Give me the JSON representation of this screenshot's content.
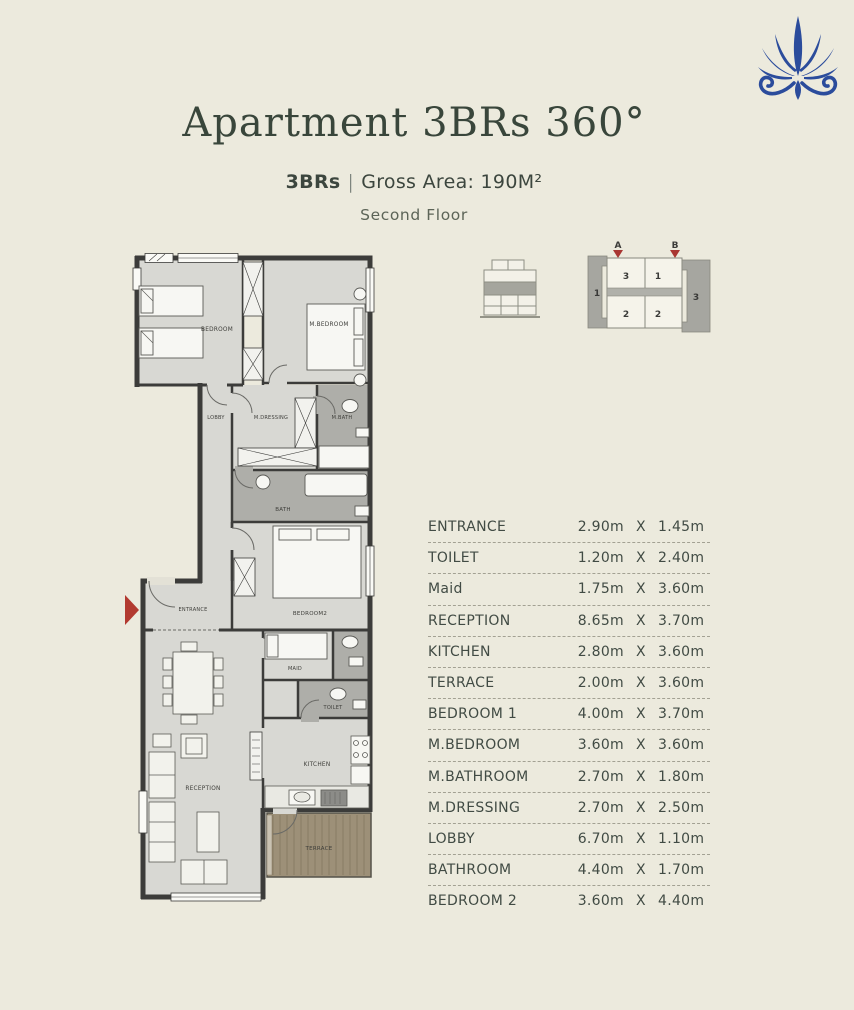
{
  "header": {
    "title": "Apartment 3BRs 360°",
    "unit_type": "3BRs",
    "separator": "|",
    "gross_area": "Gross Area: 190M²",
    "floor": "Second Floor"
  },
  "colors": {
    "background": "#ECEADD",
    "title_green": "#39463B",
    "table_text": "#414B44",
    "logo_blue": "#2B4C9C",
    "wall_dark": "#3C3C3A",
    "room_fill": "#D8D8D3",
    "wet_room_fill": "#AEAEA9",
    "terrace_wood": "#9D9078",
    "entrance_arrow_red": "#B23A30"
  },
  "key_plan": {
    "marker_a": "A",
    "marker_b": "B",
    "side_left_unit": "1",
    "side_right_unit": "3",
    "unit_top_left": "3",
    "unit_top_right": "1",
    "unit_bottom_left": "2",
    "unit_bottom_right": "2"
  },
  "floor_plan": {
    "labels": {
      "bedroom": "BEDROOM",
      "m_bedroom": "M.BEDROOM",
      "lobby": "LOBBY",
      "m_dressing": "M.DRESSING",
      "m_bath": "M.BATH",
      "bath": "BATH",
      "entrance": "ENTRANCE",
      "bedroom2": "BEDROOM2",
      "maid": "MAID",
      "toilet": "TOILET",
      "kitchen": "KITCHEN",
      "reception": "RECEPTION",
      "terrace": "TERRACE"
    }
  },
  "dimensions_table": {
    "rows": [
      {
        "label": "ENTRANCE",
        "width": "2.90m",
        "x": "X",
        "depth": "1.45m"
      },
      {
        "label": "TOILET",
        "width": "1.20m",
        "x": "X",
        "depth": "2.40m"
      },
      {
        "label": "Maid",
        "width": "1.75m",
        "x": "X",
        "depth": "3.60m"
      },
      {
        "label": "RECEPTION",
        "width": "8.65m",
        "x": "X",
        "depth": "3.70m"
      },
      {
        "label": "KITCHEN",
        "width": "2.80m",
        "x": "X",
        "depth": "3.60m"
      },
      {
        "label": "TERRACE",
        "width": "2.00m",
        "x": "X",
        "depth": "3.60m"
      },
      {
        "label": "BEDROOM 1",
        "width": "4.00m",
        "x": "X",
        "depth": "3.70m"
      },
      {
        "label": "M.BEDROOM",
        "width": "3.60m",
        "x": "X",
        "depth": "3.60m"
      },
      {
        "label": "M.BATHROOM",
        "width": "2.70m",
        "x": "X",
        "depth": "1.80m"
      },
      {
        "label": "M.DRESSING",
        "width": "2.70m",
        "x": "X",
        "depth": "2.50m"
      },
      {
        "label": "LOBBY",
        "width": "6.70m",
        "x": "X",
        "depth": "1.10m"
      },
      {
        "label": "BATHROOM",
        "width": "4.40m",
        "x": "X",
        "depth": "1.70m"
      },
      {
        "label": "BEDROOM 2",
        "width": "3.60m",
        "x": "X",
        "depth": "4.40m"
      }
    ]
  }
}
